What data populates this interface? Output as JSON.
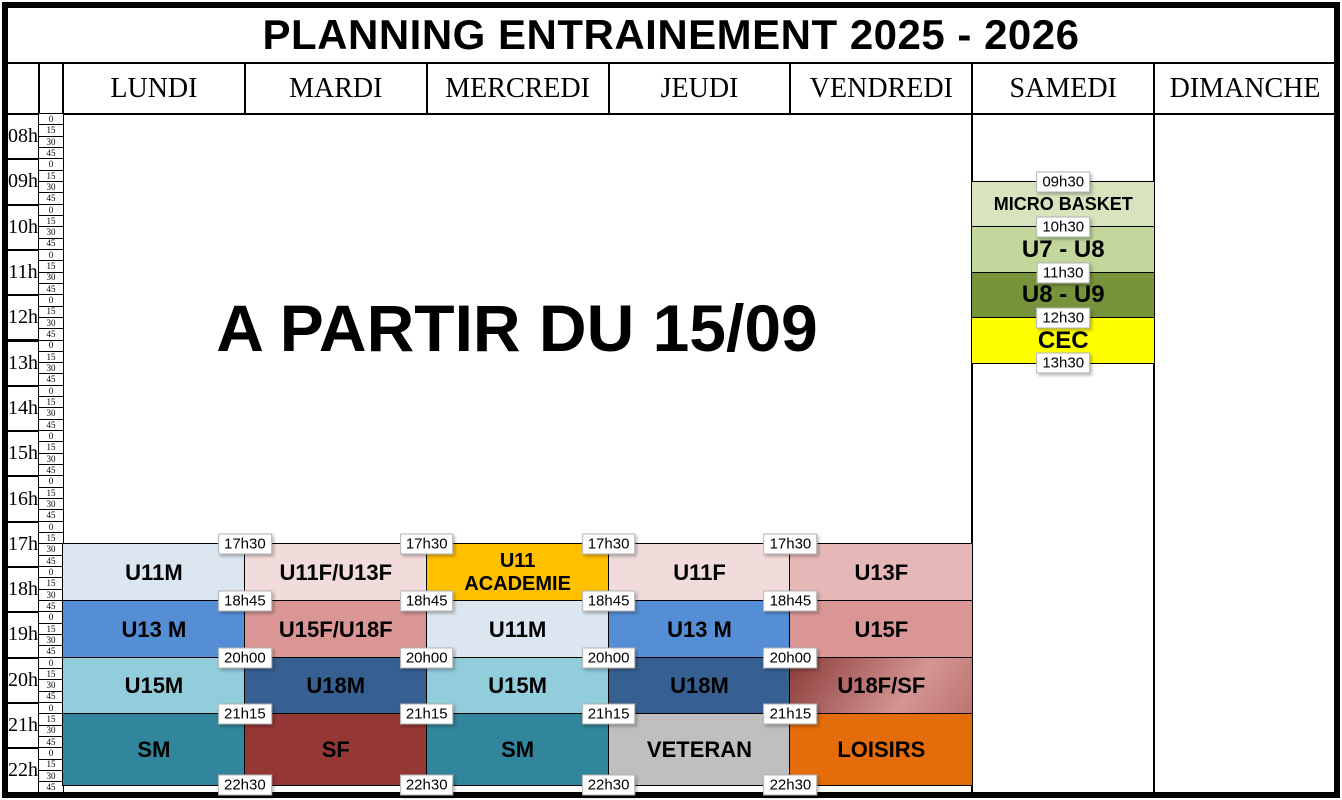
{
  "title": "PLANNING ENTRAINEMENT 2025 - 2026",
  "notice": "A PARTIR DU 15/09",
  "day_headers": [
    "LUNDI",
    "MARDI",
    "MERCREDI",
    "JEUDI",
    "VENDREDI",
    "SAMEDI",
    "DIMANCHE"
  ],
  "hour_labels": [
    "08h",
    "09h",
    "10h",
    "11h",
    "12h",
    "13h",
    "14h",
    "15h",
    "16h",
    "17h",
    "18h",
    "19h",
    "20h",
    "21h",
    "22h"
  ],
  "quarter_labels": [
    "0",
    "15",
    "30",
    "45"
  ],
  "weekday_time_labels": [
    "17h30",
    "18h45",
    "20h00",
    "21h15",
    "22h30"
  ],
  "saturday_time_labels": [
    "09h30",
    "10h30",
    "11h30",
    "12h30",
    "13h30"
  ],
  "weekday_slots": [
    {
      "start": "17h30",
      "end": "18h45",
      "sessions": [
        {
          "day": "LUNDI",
          "label": "U11M",
          "color": "#dce6f1"
        },
        {
          "day": "MARDI",
          "label": "U11F/U13F",
          "color": "#f2dcdb"
        },
        {
          "day": "MERCREDI",
          "label": "U11 ACADEMIE",
          "lines": [
            "U11",
            "ACADEMIE"
          ],
          "color": "#ffc000"
        },
        {
          "day": "JEUDI",
          "label": "U11F",
          "color": "#f2dcdb"
        },
        {
          "day": "VENDREDI",
          "label": "U13F",
          "color": "#e5b8b7"
        }
      ]
    },
    {
      "start": "18h45",
      "end": "20h00",
      "sessions": [
        {
          "day": "LUNDI",
          "label": "U13 M",
          "color": "#558ed5"
        },
        {
          "day": "MARDI",
          "label": "U15F/U18F",
          "color": "#d99694"
        },
        {
          "day": "MERCREDI",
          "label": "U11M",
          "color": "#dce6f1"
        },
        {
          "day": "JEUDI",
          "label": "U13 M",
          "color": "#558ed5"
        },
        {
          "day": "VENDREDI",
          "label": "U15F",
          "color": "#d99694"
        }
      ]
    },
    {
      "start": "20h00",
      "end": "21h15",
      "sessions": [
        {
          "day": "LUNDI",
          "label": "U15M",
          "color": "#92cddc"
        },
        {
          "day": "MARDI",
          "label": "U18M",
          "color": "#376092"
        },
        {
          "day": "MERCREDI",
          "label": "U15M",
          "color": "#92cddc"
        },
        {
          "day": "JEUDI",
          "label": "U18M",
          "color": "#376092"
        },
        {
          "day": "VENDREDI",
          "label": "U18F/SF",
          "gradient": [
            "#8a3b38",
            "#d49593",
            "#bd7370"
          ]
        }
      ]
    },
    {
      "start": "21h15",
      "end": "22h30",
      "sessions": [
        {
          "day": "LUNDI",
          "label": "SM",
          "color": "#31859c"
        },
        {
          "day": "MARDI",
          "label": "SF",
          "color": "#953735"
        },
        {
          "day": "MERCREDI",
          "label": "SM",
          "color": "#31859c"
        },
        {
          "day": "JEUDI",
          "label": "VETERAN",
          "color": "#bfbfbf"
        },
        {
          "day": "VENDREDI",
          "label": "LOISIRS",
          "color": "#e46c0a"
        }
      ]
    }
  ],
  "saturday_slots": [
    {
      "start": "09h30",
      "end": "10h30",
      "label": "MICRO BASKET",
      "color": "#d7e4bd"
    },
    {
      "start": "10h30",
      "end": "11h30",
      "label": "U7 - U8",
      "color": "#c3d69b"
    },
    {
      "start": "11h30",
      "end": "12h30",
      "label": "U8 - U9",
      "color": "#77933c"
    },
    {
      "start": "12h30",
      "end": "13h30",
      "label": "CEC",
      "color": "#ffff00"
    }
  ]
}
